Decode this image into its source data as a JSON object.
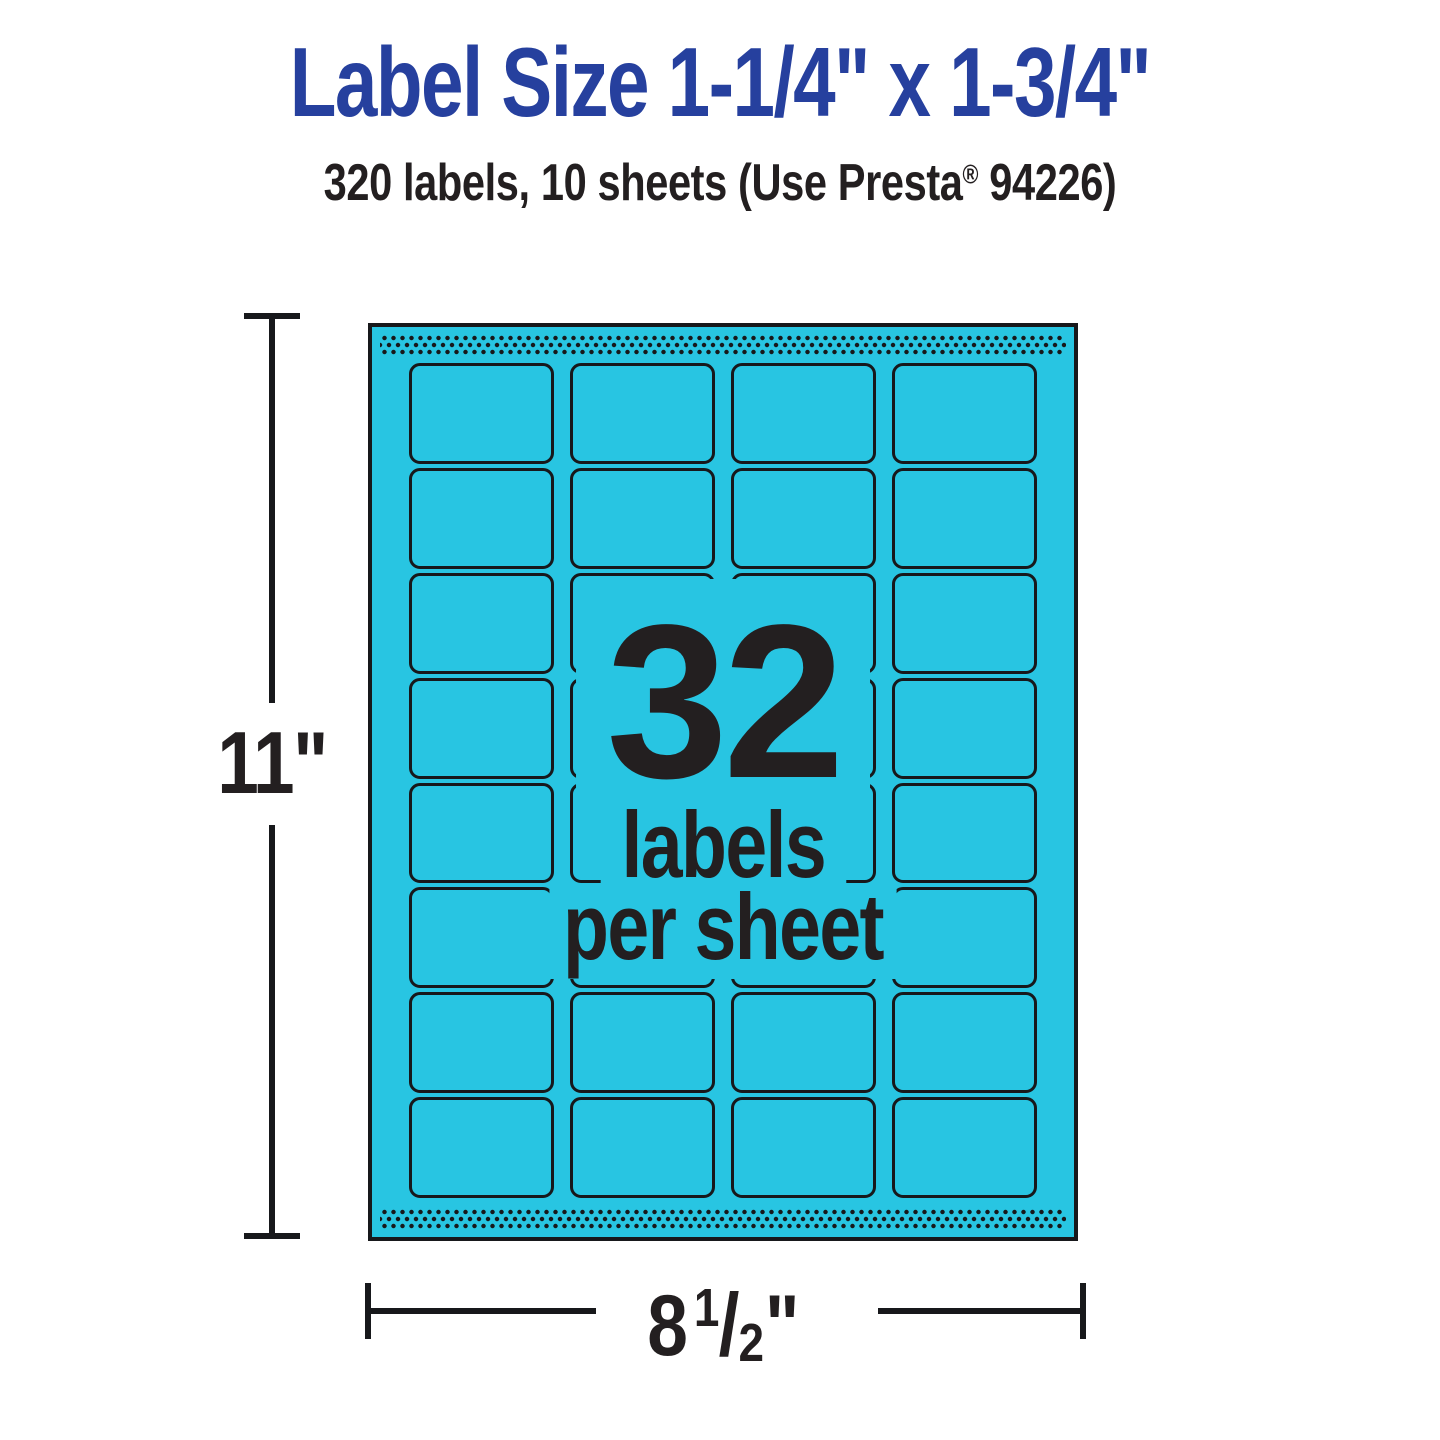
{
  "page": {
    "title": "Label Size 1-1/4\" x 1-3/4\"",
    "subtitle": {
      "prefix": "320 labels, 10 sheets (Use Presta",
      "registered_mark": "®",
      "suffix": " 94226)"
    }
  },
  "sheet": {
    "overlay": {
      "count": "32",
      "caption_line1": "labels",
      "caption_line2": "per sheet"
    },
    "grid": {
      "rows": 8,
      "columns": 4,
      "total_labels": 32
    }
  },
  "dimensions": {
    "height": {
      "value": "11\""
    },
    "width": {
      "whole": "8",
      "fraction_numerator": "1",
      "fraction_slash": "/",
      "fraction_denominator": "2",
      "unit": "\""
    }
  },
  "colors": {
    "cyan": "#28c5e2",
    "blue": "#26409e",
    "ink": "#17181b",
    "text": "#231f20"
  }
}
